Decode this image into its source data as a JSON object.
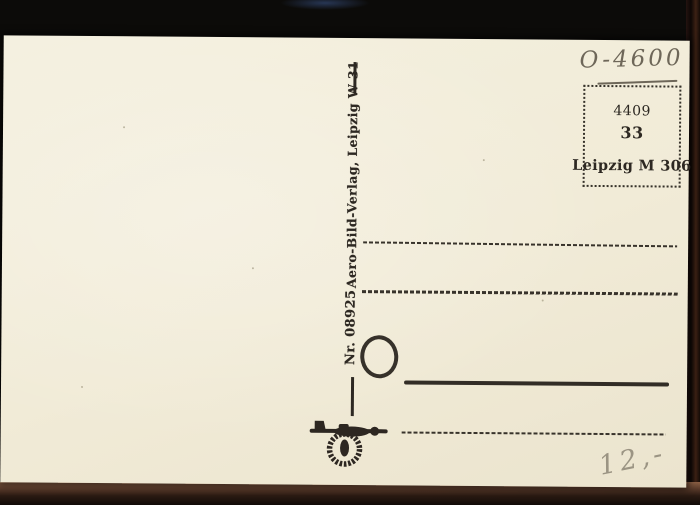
{
  "postcard": {
    "handwritten_code": "O-4600",
    "handwritten_price": "12,-",
    "publisher_imprint": "Aero-Bild-Verlag, Leipzig W 31",
    "serial_number": "Nr. 08925",
    "stamp_box": {
      "code": "4409",
      "number": "33",
      "city": "Leipzig M 306"
    },
    "logo_name": "aero-bild-verlag-airplane-wreath-logo",
    "colors": {
      "paper": "#f2ecd9",
      "ink": "#2d2822",
      "pencil": "#6e6759",
      "pencil_light": "#9b9483",
      "scan_background": "#0a0908"
    }
  }
}
